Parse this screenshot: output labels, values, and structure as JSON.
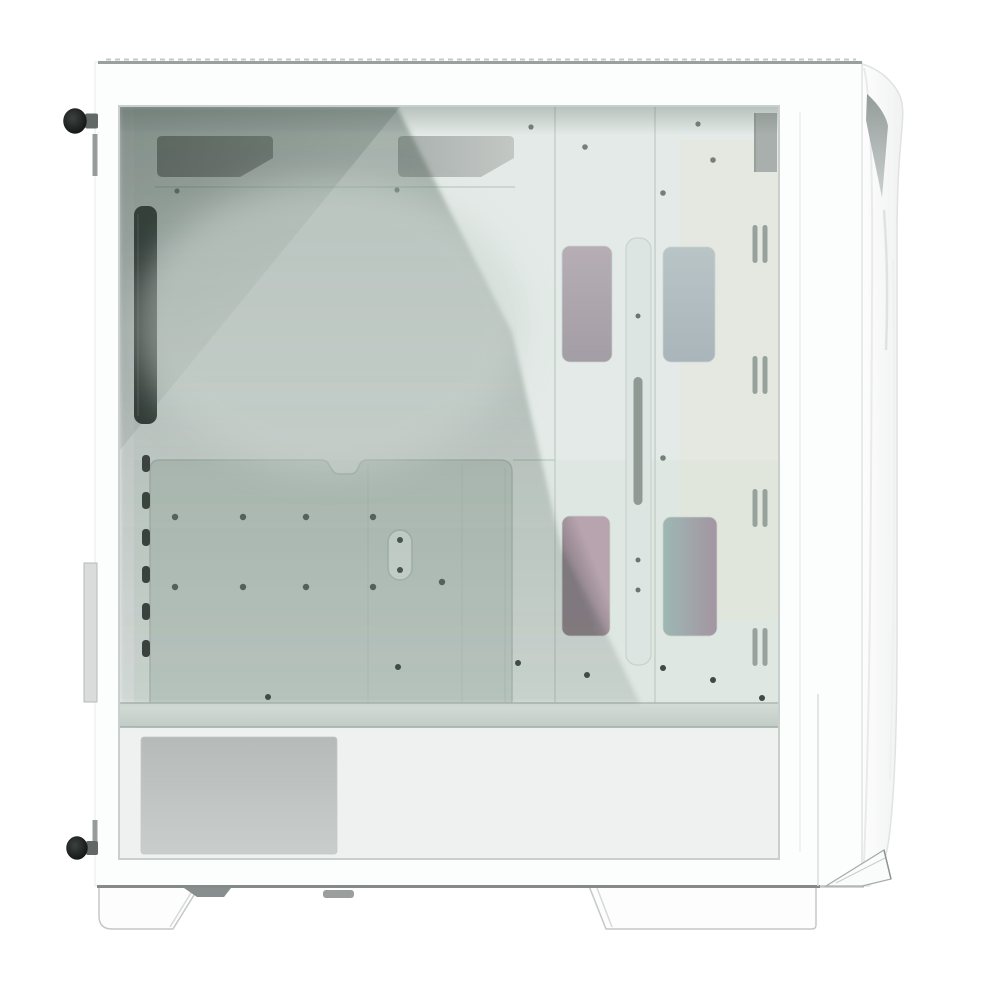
{
  "scene": {
    "description": "White mid-tower PC case shown from the left side with a tempered glass side panel revealing an empty white interior",
    "backdrop": "plain white studio background"
  },
  "colors": {
    "backdrop": "#ffffff",
    "case_shell": "#fcfdfd",
    "top_edge": "#9aa09f",
    "bottom_edge": "#848a89",
    "glass_base": "#dfe7e3",
    "glass_reflection": "#46584f",
    "corner_shade": "#2f3e37",
    "top_shade": "#4b5a53",
    "interior_upper_wall": "#e4ebe8",
    "warm_tint": "#e9e4d2",
    "motherboard_tray": "#c9d5cf",
    "tray_outline": "#b5c2bc",
    "rear_exhaust": "#2e3230",
    "expansion_slot": "#383d3b",
    "grommet_dark": "#858884",
    "grommet_dark2": "#989c98",
    "grommet_light": "#a9b0ad",
    "grommet_light2": "#c2c7c4",
    "cable_bar": "#dce5e1",
    "cable_slot": "#8f9a94",
    "cutout_mauve": "#b6aeb4",
    "cutout_mauve2": "#a39da5",
    "cutout_blue": "#b9c4c7",
    "cutout_blue2": "#a9b5ba",
    "iridescent_pink": "#b7a4ae",
    "iridescent_pink_deep": "#8d8089",
    "iridescent_teal": "#9db8b3",
    "iridescent_mauve": "#a495a1",
    "vent_slot": "#97a29d",
    "front_bracket": "#a9afac",
    "floor_band_light": "#d4dcd7",
    "floor_band": "#c2ccc6",
    "psu_shroud": "#eff1f0",
    "shroud_vent": "#b6bab9",
    "shroud_vent2": "#c9cdcc",
    "standoff": "#4c5751",
    "floor_screw": "#3f4a44",
    "cloud": "#ccd5d0",
    "thumbscrew_head": "#0e1010",
    "thumbscrew_head_hl": "#3c4140",
    "thumbscrew_stem": "#626866",
    "bracket_tab": "#d9dcdb",
    "foot_fill": "#fdfdfd",
    "foot_outline": "#c4c8c7",
    "foot_pad": "#888e8d",
    "panel_crease": "#8f9896",
    "panel_crease2": "#c9cecd",
    "panel_edge": "#e0e3e2"
  },
  "hardware": {
    "thumbscrews": 2,
    "feet": 2,
    "expansion_slot_covers": 6,
    "front_vent_slot_pairs": 4,
    "drive_cage_cutouts": 4,
    "cable_grommets": 2,
    "motherboard_standoffs": 8
  }
}
